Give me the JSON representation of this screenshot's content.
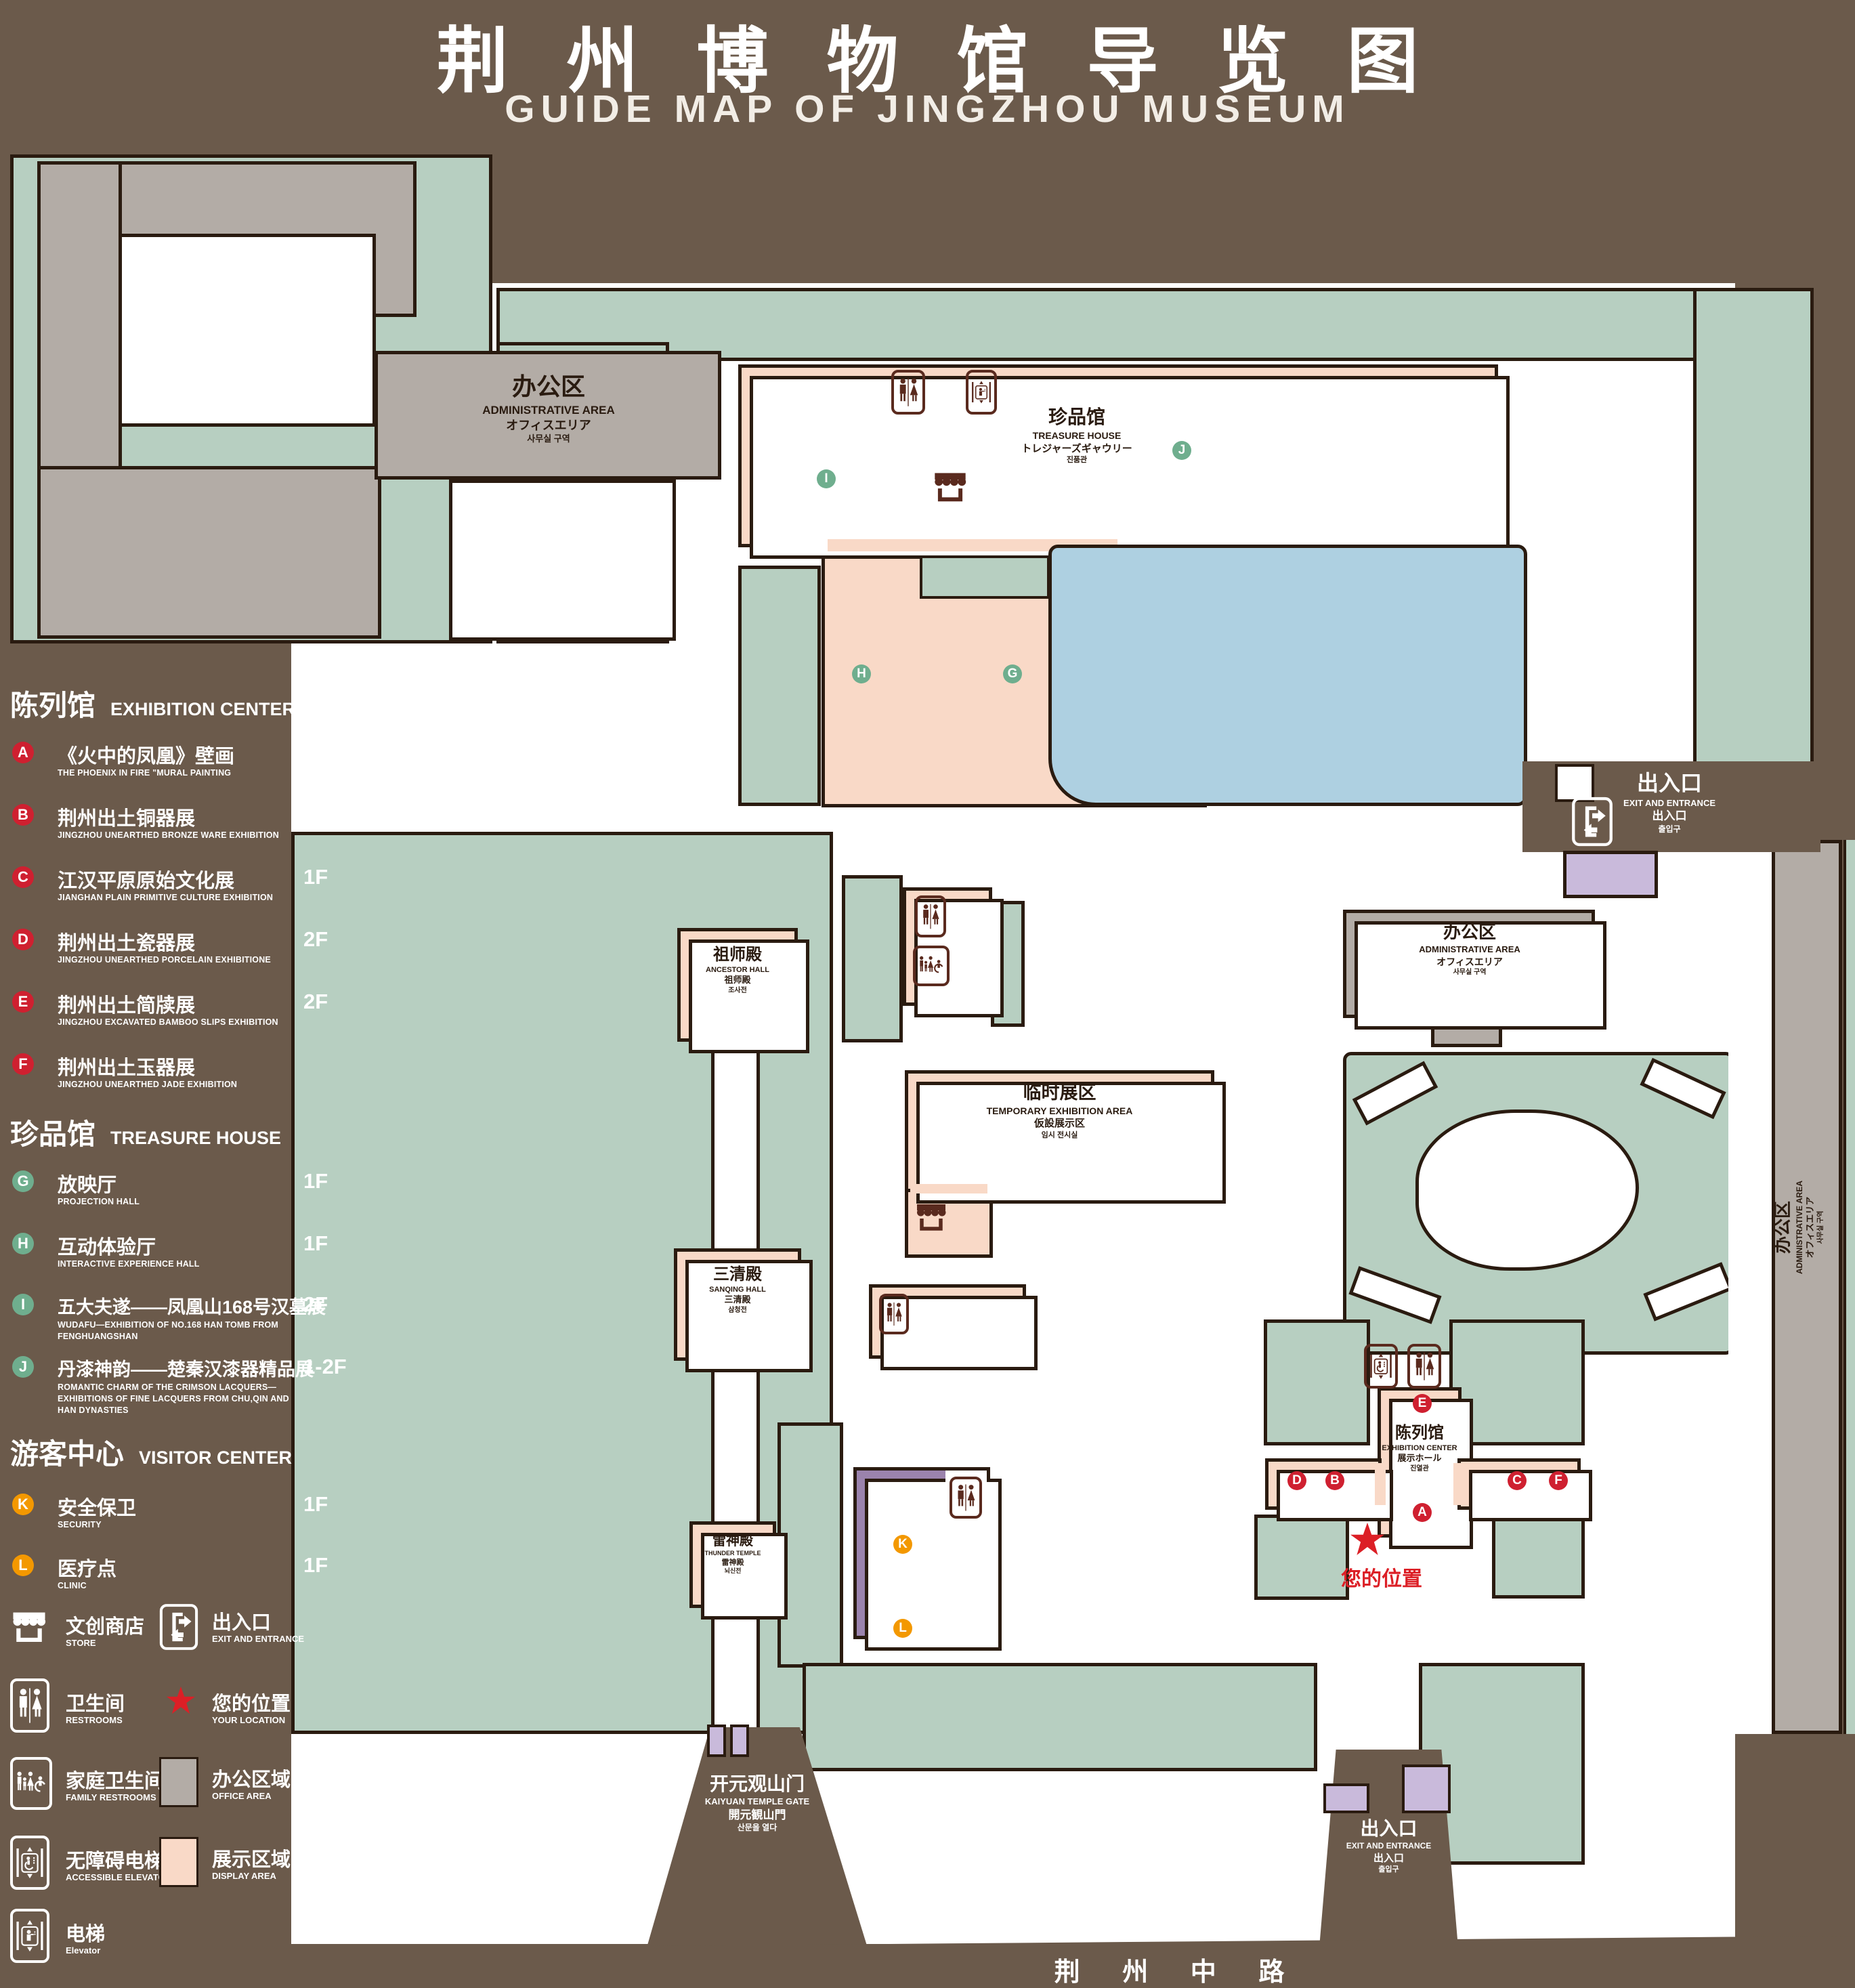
{
  "title": {
    "zh": "荆州博物馆导览图",
    "en": "GUIDE MAP OF JINGZHOU MUSEUM"
  },
  "legend": {
    "sections": [
      {
        "zh": "陈列馆",
        "en": "EXHIBITION CENTER",
        "items": [
          {
            "id": "A",
            "zh": "《火中的凤凰》壁画",
            "en": "THE PHOENIX IN FIRE \"MURAL PAINTING",
            "floor": "1F"
          },
          {
            "id": "B",
            "zh": "荆州出土铜器展",
            "en": "JINGZHOU UNEARTHED BRONZE WARE EXHIBITION",
            "floor": "1F"
          },
          {
            "id": "C",
            "zh": "江汉平原原始文化展",
            "en": "JIANGHAN PLAIN PRIMITIVE CULTURE EXHIBITION",
            "floor": "1F"
          },
          {
            "id": "D",
            "zh": "荆州出土瓷器展",
            "en": "JINGZHOU UNEARTHED PORCELAIN EXHIBITIONE",
            "floor": "2F"
          },
          {
            "id": "E",
            "zh": "荆州出土简牍展",
            "en": "JINGZHOU EXCAVATED BAMBOO SLIPS EXHIBITION",
            "floor": "2F"
          },
          {
            "id": "F",
            "zh": "荆州出土玉器展",
            "en": "JINGZHOU UNEARTHED JADE EXHIBITION",
            "floor": "2F"
          }
        ]
      },
      {
        "zh": "珍品馆",
        "en": "TREASURE HOUSE",
        "items": [
          {
            "id": "G",
            "zh": "放映厅",
            "en": "PROJECTION HALL",
            "floor": "1F"
          },
          {
            "id": "H",
            "zh": "互动体验厅",
            "en": "INTERACTIVE EXPERIENCE HALL",
            "floor": "1F"
          },
          {
            "id": "I",
            "zh": "五大夫遂——凤凰山168号汉墓展",
            "en": "WUDAFU—EXHIBITION OF NO.168 HAN TOMB FROM FENGHUANGSHAN",
            "floor": "2F"
          },
          {
            "id": "J",
            "zh": "丹漆神韵——楚秦汉漆器精品展",
            "en": "ROMANTIC CHARM OF THE CRIMSON LACQUERS—EXHIBITIONS OF FINE LACQUERS FROM CHU,QIN AND HAN DYNASTIES",
            "floor": "1-2F"
          }
        ]
      },
      {
        "zh": "游客中心",
        "en": "VISITOR CENTER",
        "items": [
          {
            "id": "K",
            "zh": "安全保卫",
            "en": "SECURITY",
            "floor": "1F"
          },
          {
            "id": "L",
            "zh": "医疗点",
            "en": "CLINIC",
            "floor": "1F"
          }
        ]
      }
    ],
    "symbols": [
      {
        "zh": "文创商店",
        "en": "STORE"
      },
      {
        "zh": "出入口",
        "en": "EXIT AND ENTRANCE"
      },
      {
        "zh": "卫生间",
        "en": "RESTROOMS"
      },
      {
        "zh": "您的位置",
        "en": "YOUR LOCATION"
      },
      {
        "zh": "家庭卫生间",
        "en": "FAMILY RESTROOMS"
      },
      {
        "zh": "办公区域",
        "en": "OFFICE AREA"
      },
      {
        "zh": "无障碍电梯",
        "en": "ACCESSIBLE ELEVATOR"
      },
      {
        "zh": "展示区域",
        "en": "DISPLAY AREA"
      },
      {
        "zh": "电梯",
        "en": "Elevator"
      }
    ]
  },
  "map": {
    "buildings": {
      "admin_nw": {
        "zh": "办公区",
        "en": "ADMINISTRATIVE AREA",
        "jp": "オフィスエリア",
        "kr": "사무실 구역"
      },
      "admin_mid": {
        "zh": "办公区",
        "en": "ADMINISTRATIVE AREA",
        "jp": "オフィスエリア",
        "kr": "사무실 구역"
      },
      "admin_right": {
        "zh": "办公区",
        "en": "ADMINISTRATIVE AREA",
        "jp": "オフィスエリア",
        "kr": "사무실 구역"
      },
      "treasure_house": {
        "zh": "珍品馆",
        "en": "TREASURE HOUSE",
        "jp": "トレジャーズギャウリー",
        "kr": "진품관"
      },
      "ancestor_hall": {
        "zh": "祖师殿",
        "en": "ANCESTOR HALL",
        "jp": "祖师殿",
        "kr": "조사전"
      },
      "temporary": {
        "zh": "临时展区",
        "en": "TEMPORARY EXHIBITION AREA",
        "jp": "仮設展示区",
        "kr": "임시 전시실"
      },
      "sanqing": {
        "zh": "三清殿",
        "en": "SANQING HALL",
        "jp": "三清殿",
        "kr": "삼청전"
      },
      "thunder": {
        "zh": "雷神殿",
        "en": "THUNDER TEMPLE",
        "jp": "雷神殿",
        "kr": "뇌신전"
      },
      "visitor": {
        "zh": "游客中心",
        "en": "VISITOR CENTER",
        "jp": "ビジターセンター",
        "kr": "관광객 센터"
      },
      "exhibition": {
        "zh": "陈列馆",
        "en": "EXHIBITION CENTER",
        "jp": "展示ホール",
        "kr": "진열관"
      },
      "exit_right": {
        "zh": "出入口",
        "en": "EXIT AND ENTRANCE",
        "jp": "出入口",
        "kr": "출입구"
      },
      "exit_bottom": {
        "zh": "出入口",
        "en": "EXIT AND ENTRANCE",
        "jp": "出入口",
        "kr": "출입구"
      },
      "gate": {
        "zh": "开元观山门",
        "en": "KAIYUAN TEMPLE GATE",
        "jp": "開元観山門",
        "kr": "산문을 열다"
      },
      "road": {
        "zh": "荆 州 中 路"
      },
      "your_location": {
        "zh": "您的位置"
      }
    }
  },
  "colors": {
    "background": "#6b5a4b",
    "outline": "#2a1b10",
    "landscape_green": "#b7cfc1",
    "display_area_pink": "#f9d9c7",
    "office_gray": "#b3aca6",
    "pond_blue": "#aed0e1",
    "visitor_purple": "#9b83ad",
    "lavender": "#c9badb",
    "icon_dark": "#5a2a1e",
    "badge_red": "#cf2030",
    "badge_green": "#6fae8e",
    "badge_orange": "#f39800",
    "location_red": "#dc1f26"
  }
}
